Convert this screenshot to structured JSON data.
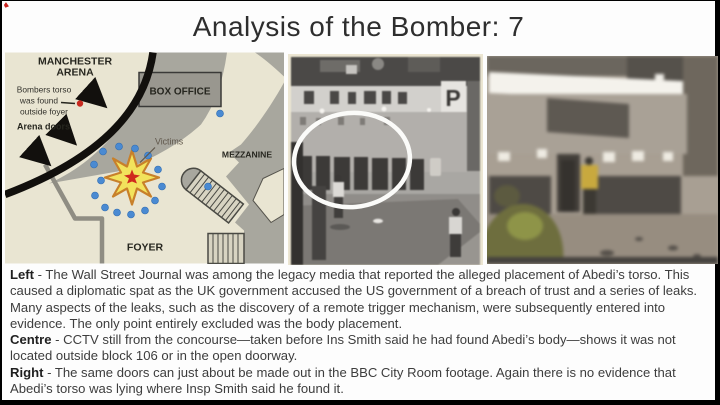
{
  "slide": {
    "title": "Analysis of the Bomber: 7"
  },
  "map": {
    "arena_line1": "MANCHESTER",
    "arena_line2": "ARENA",
    "torso_line1": "Bombers torso",
    "torso_line2": "was found",
    "torso_line3": "outside foyer",
    "arena_doors_label": "Arena doors",
    "box_office_label": "BOX OFFICE",
    "victims_label": "Victims",
    "mezzanine_label": "MEZZANINE",
    "foyer_label": "FOYER",
    "colors": {
      "background_cream": "#e9e5d2",
      "structure_gray": "#a8a79e",
      "victim_dot_blue": "#4a8ad2",
      "torso_dot_red": "#c82a20",
      "blast_yellow": "#f2e35c",
      "blast_outline_orange": "#c8802a",
      "blast_core_red": "#cf2b1d"
    }
  },
  "cctv": {
    "p_sign": "P",
    "annotation": "white-ellipse-highlighting-doorway"
  },
  "footage": {
    "description": "blurry-bbc-city-room-frame"
  },
  "captions": {
    "left_lead": "Left",
    "left_body": " - The Wall Street Journal was among the legacy media that reported the alleged placement of Abedi’s torso. This caused a diplomatic spat as the UK government accused the US government of a breach of trust and a series of leaks. Many aspects of the leaks, such as the discovery of a remote trigger mechanism, were subsequently entered into evidence. The only point entirely excluded was the body placement.",
    "centre_lead": "Centre",
    "centre_body": " - CCTV still from the concourse—taken before Ins Smith said he had found Abedi’s body—shows it was not located outside block 106 or in the open doorway.",
    "right_lead": "Right",
    "right_body": " - The same doors can just about be made out in the BBC City Room footage. Again there is no evidence that Abedi’s torso was lying where Insp Smith said he found it."
  }
}
